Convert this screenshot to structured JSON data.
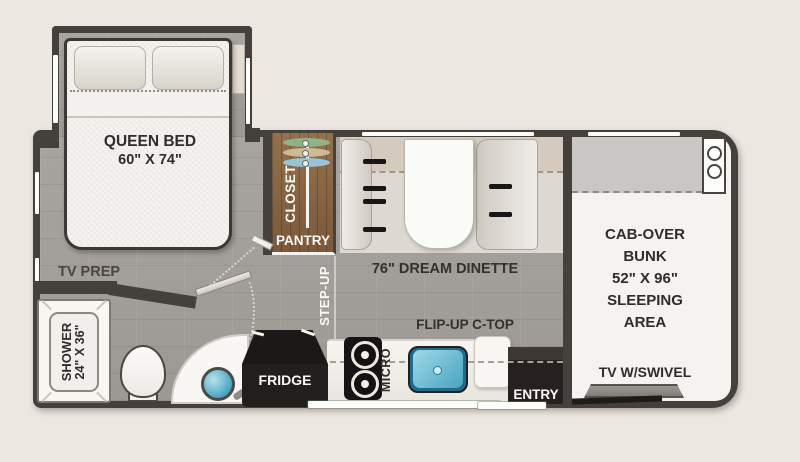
{
  "labels": {
    "queen_bed": [
      "QUEEN BED",
      "60\" X 74\""
    ],
    "tv_prep": "TV PREP",
    "closet": "CLOSET",
    "pantry": "PANTRY",
    "dinette": "76\" DREAM DINETTE",
    "step_up": "STEP-UP",
    "bunk_lines": [
      "CAB-OVER",
      "BUNK",
      "52\" X 96\"",
      "SLEEPING",
      "AREA"
    ],
    "tv_swivel": "TV W/SWIVEL",
    "flip_up_ctop": "FLIP-UP C-TOP",
    "fridge": "FRIDGE",
    "micro": "MICRO",
    "entry": "ENTRY",
    "shower": [
      "SHOWER",
      "24\" X 36\""
    ]
  },
  "colors": {
    "background": "#ece8e1",
    "wall": "#44403b",
    "floor": "#a39f9b",
    "bunk_floor": "#f4f3f0",
    "closet_wood": "#8a6847",
    "sink_blue": "#5fb0c8",
    "hanger_green": "#8fb286",
    "hanger_tan": "#cdbb97",
    "hanger_blue": "#98c4d8"
  }
}
